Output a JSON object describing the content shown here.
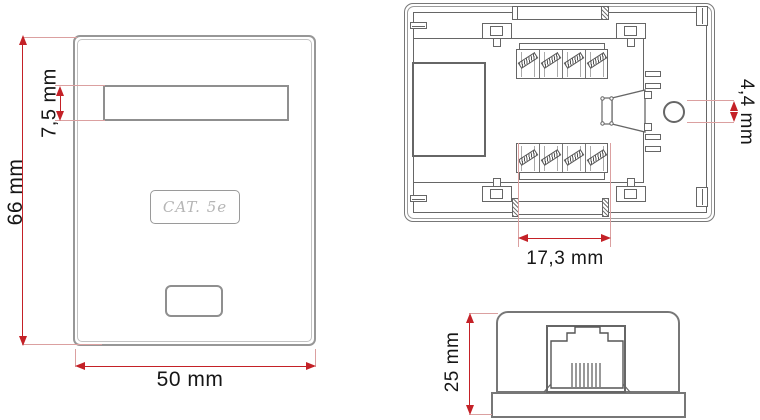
{
  "product_label": "CAT. 5e",
  "dimensions": {
    "front_height": "66 mm",
    "front_width": "50 mm",
    "label_window_height": "7,5 mm",
    "punch_block_width": "17,3 mm",
    "cable_hole_diameter": "4,4 mm",
    "box_depth": "25 mm"
  },
  "colors": {
    "dimension_red": "#c42127",
    "extension_pink": "#dba0a0",
    "drawing_line": "#666666",
    "plate_outline": "#979797",
    "engraved_text": "#b5b5b5",
    "background": "#ffffff"
  }
}
